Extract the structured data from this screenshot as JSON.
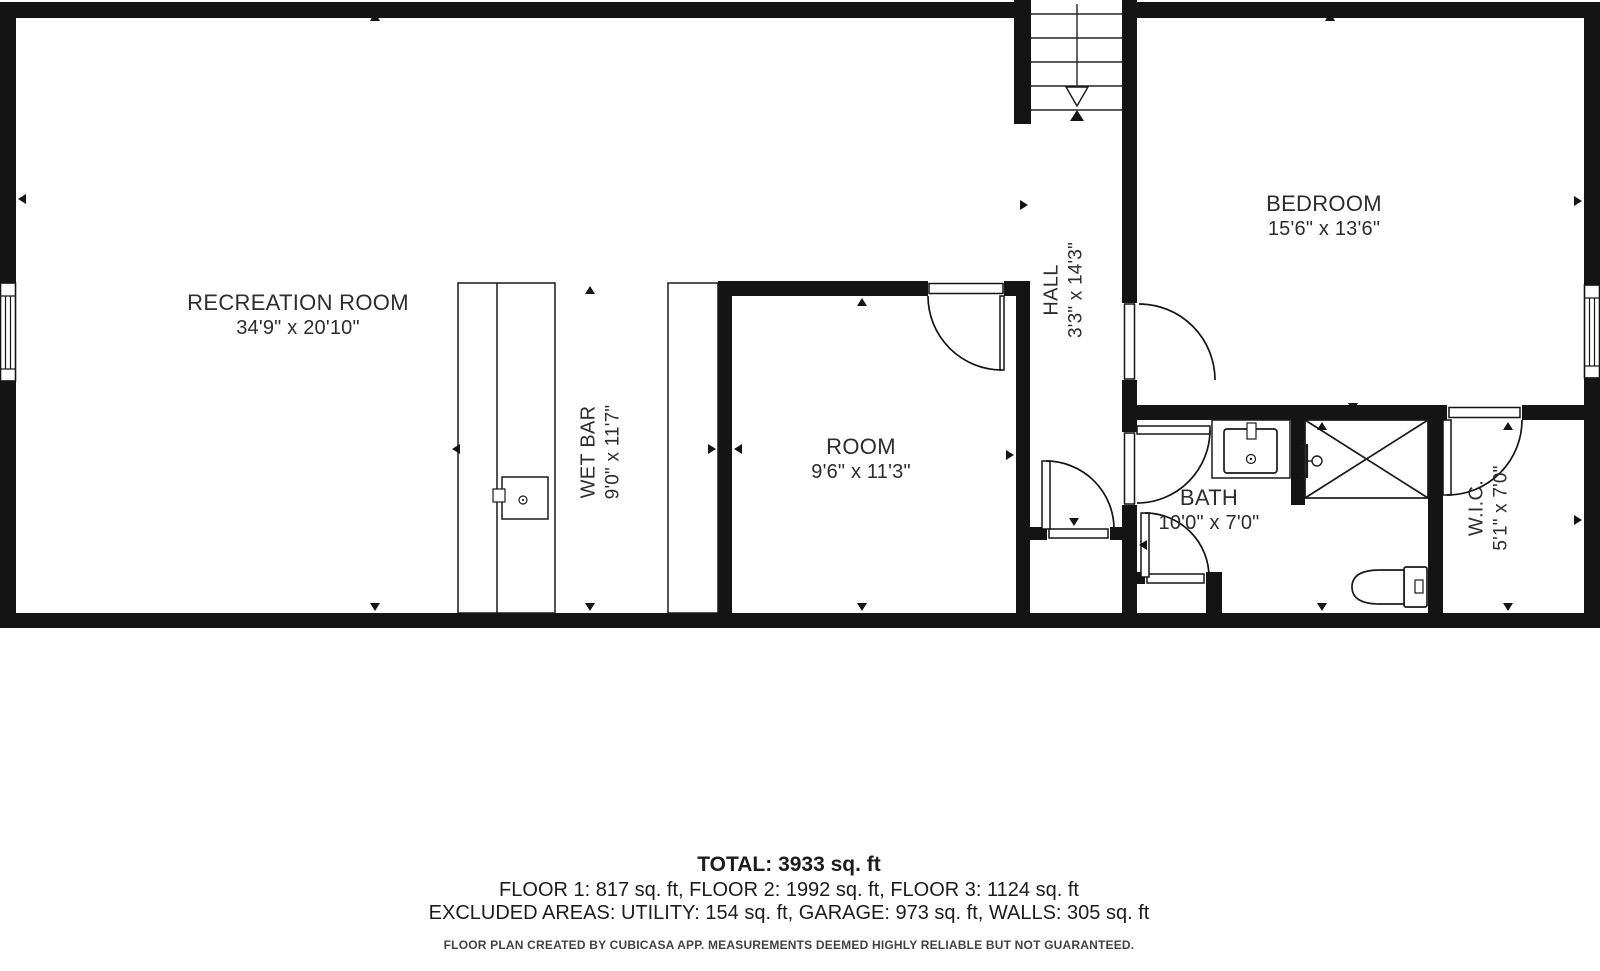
{
  "plan": {
    "rooms": [
      {
        "name": "RECREATION ROOM",
        "dims": "34'9\" x 20'10\""
      },
      {
        "name": "WET BAR",
        "dims": "9'0\" x 11'7\""
      },
      {
        "name": "ROOM",
        "dims": "9'6\" x 11'3\""
      },
      {
        "name": "HALL",
        "dims": "3'3\" x 14'3\""
      },
      {
        "name": "BEDROOM",
        "dims": "15'6\" x 13'6\""
      },
      {
        "name": "BATH",
        "dims": "10'0\" x 7'0\""
      },
      {
        "name": "W.I.C.",
        "dims": "5'1\" x 7'0\""
      }
    ],
    "fixtures": {
      "stairs": "staircase-down-arrow",
      "wet_bar_sink": "wet-bar-sink",
      "bath_sink": "bathroom-sink",
      "shower": "shower-stall",
      "toilet": "toilet",
      "windows": [
        "left-wall-window",
        "right-wall-window"
      ],
      "doors": [
        "room-door",
        "bedroom-door",
        "bath-door-upper",
        "bath-door-lower",
        "hall-door",
        "wic-door"
      ]
    },
    "colors": {
      "wall": "#141414",
      "line": "#1a1a1a",
      "text": "#2d2d2d",
      "footnote": "#424242"
    }
  },
  "summary": {
    "total": "TOTAL: 3933 sq. ft",
    "floors": "FLOOR 1: 817 sq. ft, FLOOR 2: 1992 sq. ft, FLOOR 3: 1124 sq. ft",
    "excluded": "EXCLUDED AREAS: UTILITY: 154 sq. ft, GARAGE: 973 sq. ft, WALLS: 305 sq. ft",
    "disclaimer": "FLOOR PLAN CREATED BY CUBICASA APP. MEASUREMENTS DEEMED HIGHLY RELIABLE BUT NOT GUARANTEED."
  }
}
